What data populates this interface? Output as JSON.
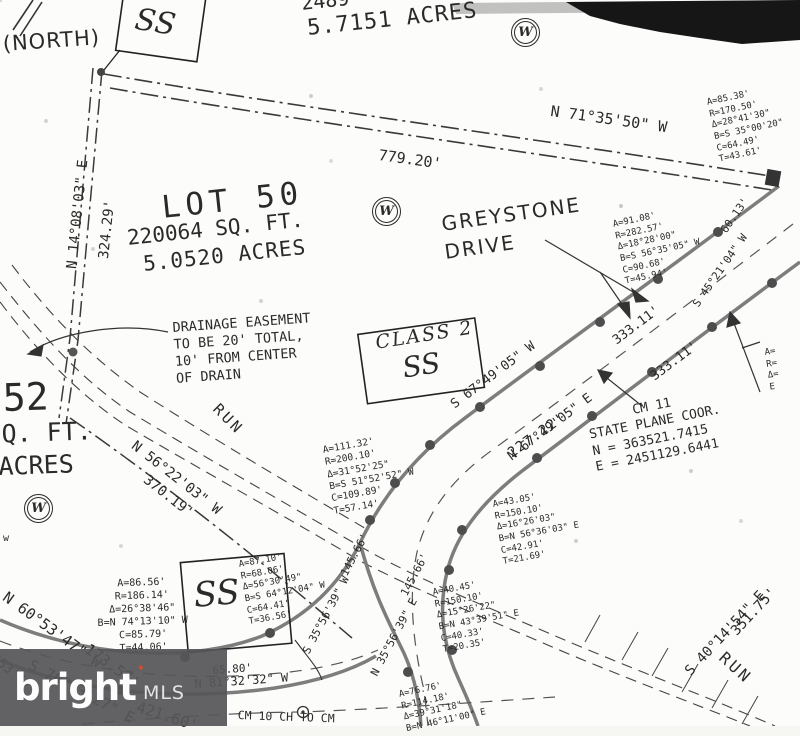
{
  "labels": {
    "north": "(NORTH)",
    "top_sqft_partial": "2489",
    "top_acres": "5.7151 ACRES",
    "n71_bearing": "N 71°35'50\" W",
    "n71_dist": "779.20'",
    "lot50_name": "LOT 50",
    "lot50_sqft": "220064 SQ. FT.",
    "lot50_acres": "5.0520 ACRES",
    "greystone_line1": "GREYSTONE",
    "greystone_line2": "DRIVE",
    "s45_dist": "60.13'",
    "s45_bearing": "S 45°21'04\" W",
    "class2_line1": "CLASS 2",
    "class2_line2": "SS",
    "ss_top": "SS",
    "ss_bottom": "SS",
    "s67_bearing": "S 67°49'05\" W",
    "s67_dist": "333.11'",
    "n67_bearing": "N 67°49'05\" E",
    "n67_dist": "333.11'",
    "n14_bearing": "N 14°08'03\" E",
    "n14_dist": "324.29'",
    "run_upper": "RUN",
    "run_lower": "RUN",
    "lot52_num": "52",
    "lot52_sqft": "SQ. FT.",
    "lot52_acres": "ACRES",
    "n56_bearing": "N 56°22'03\" W",
    "n56_dist": "370.19'",
    "d227": "227.22'",
    "n60_bearing": "N 60°53'47\" W",
    "n60_dist": "173.57'",
    "s76_bearing": "S 76°03'27\" E",
    "s76_dist": "421.60'",
    "sw_partial": "0°53'47\"",
    "d65": "65.80'",
    "n81_bearing": "N 81°32'32\" W",
    "s35_bearing": "S 35°56'39\" W",
    "s35_dist": "145.66'",
    "n35_bearing": "N 35°56'39\" E",
    "n35_dist": "145.66'",
    "d351": "351.75'",
    "s40_bearing": "S 40°14'54\" E",
    "cm_bottom": "CM 10 CH TO CM",
    "w_stray": "w"
  },
  "notes": {
    "drainage": "DRAINAGE EASEMENT\nTO BE 20' TOTAL,\n10' FROM CENTER\nOF DRAIN",
    "cm11": "      CM 11\nSTATE PLANE COOR.\nN = 363521.7415\nE = 2451129.6441"
  },
  "curves": {
    "c1": "A=85.38'\nR=170.50'\nΔ=28°41'30\"\nB=S 35°00'20\"\nC=64.49'\nT=43.61'",
    "c2": "A=91.08'\nR=282.57'\nΔ=18°28'00\"\nB=S 56°35'05\" W\nC=90.68'\nT=45.94'",
    "c3": "A=111.32'\nR=200.10'\nΔ=31°52'25\"\nB=S 51°52'52\" W\nC=109.89'\nT=57.14'",
    "c4": "A=43.05'\nR=150.10'\nΔ=16°26'03\"\nB=N 56°36'03\" E\nC=42.91'\nT=21.69'",
    "c5": "A=86.56'\nR=186.14'\nΔ=26°38'46\"\nB=N 74°13'10\" W\nC=85.79'\nT=44.06'",
    "c6": "A=87.10'\nR=68.06'\nΔ=56°30'49\"\nB=S 64°12'04\" W\nC=64.41'\nT=36.56'",
    "c7": "A=40.45'\nR=150.10'\nΔ=15°26'22\"\nB=N 43°39'51\" E\nC=40.33'\nT=20.35'",
    "c8": "A=76.76'\nR=114.18'\nΔ=39°31'18\"\nB=N 46°11'00\" E",
    "c9": "A=\nR=\nΔ=\nE"
  },
  "symbols": {
    "well_letter": "W"
  },
  "footer": {
    "brand": "bright",
    "suffix": "MLS",
    "star": "✦"
  },
  "colors": {
    "ink": "#2a2a2a",
    "road": "#7d7d7d",
    "scan_black": "#161616",
    "brand_star": "#dd4a2b",
    "footer_bg": "#565658"
  }
}
